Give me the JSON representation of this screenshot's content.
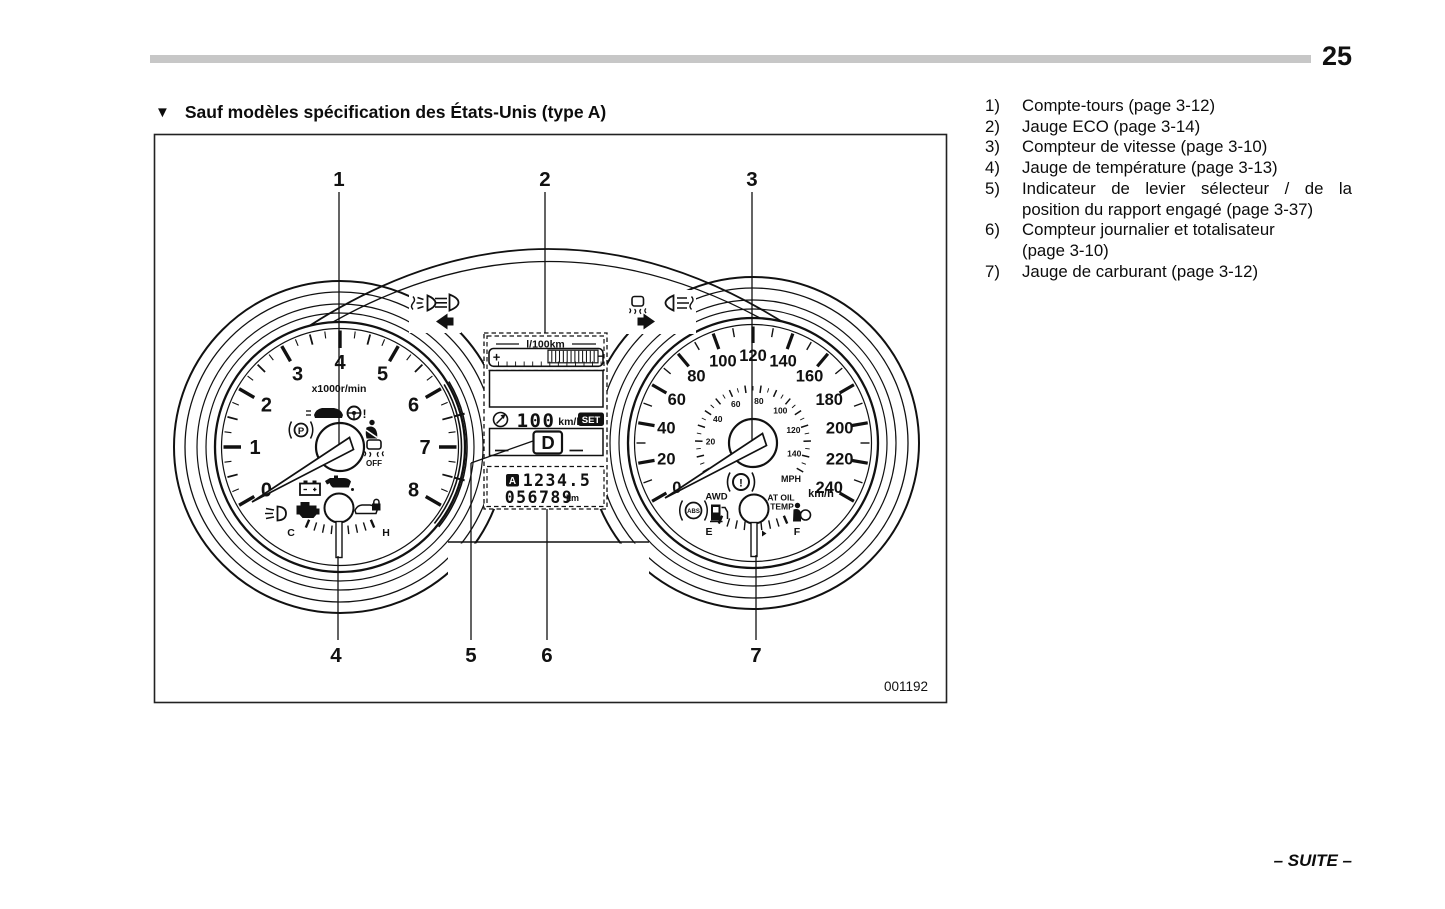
{
  "page": {
    "number": "25",
    "continuation": "– SUITE –"
  },
  "heading": {
    "marker": "▼",
    "text": "Sauf modèles spécification des États-Unis (type A)"
  },
  "figure": {
    "code": "001192"
  },
  "legend": {
    "items": [
      {
        "num": "1)",
        "lines": [
          "Compte-tours (page 3-12)"
        ]
      },
      {
        "num": "2)",
        "lines": [
          "Jauge ECO (page 3-14)"
        ]
      },
      {
        "num": "3)",
        "lines": [
          "Compteur de vitesse (page 3-10)"
        ]
      },
      {
        "num": "4)",
        "lines": [
          "Jauge de température (page 3-13)"
        ]
      },
      {
        "num": "5)",
        "lines": [
          "Indicateur de levier sélecteur / de la",
          "position du rapport engagé (page 3-37)"
        ]
      },
      {
        "num": "6)",
        "lines": [
          "Compteur journalier et totalisateur",
          "(page 3-10)"
        ]
      },
      {
        "num": "7)",
        "lines": [
          "Jauge de carburant (page 3-12)"
        ]
      }
    ]
  },
  "callouts": {
    "labels": [
      "1",
      "2",
      "3",
      "4",
      "5",
      "6",
      "7"
    ]
  },
  "cluster": {
    "tachometer": {
      "unit": "x1000r/min",
      "labels": [
        "0",
        "1",
        "2",
        "3",
        "4",
        "5",
        "6",
        "7",
        "8"
      ]
    },
    "speedometer": {
      "outer_labels": [
        "0",
        "20",
        "40",
        "60",
        "80",
        "100",
        "120",
        "140",
        "160",
        "180",
        "200",
        "220",
        "240"
      ],
      "outer_unit": "km/h",
      "inner_labels": [
        "20",
        "40",
        "60",
        "80",
        "100",
        "120",
        "140"
      ],
      "inner_unit": "MPH"
    },
    "temperature_gauge": {
      "cold": "C",
      "hot": "H"
    },
    "fuel_gauge": {
      "empty": "E",
      "full": "F"
    },
    "indicators": {
      "vdc_off": "OFF",
      "awd": "AWD",
      "abs": "ABS",
      "at_oil_temp_line1": "AT OIL",
      "at_oil_temp_line2": "TEMP",
      "brake_p": "P",
      "brake_excl": "!",
      "power_steering_excl": "!",
      "mph": "MPH",
      "kmh": "km/h"
    },
    "display": {
      "eco_title": "l/100km",
      "plus": "+",
      "minus": "−",
      "cruise_speed": "100",
      "cruise_unit": "km/h",
      "set_label": "SET",
      "gear": "D",
      "trip_label": "A",
      "trip_value": "1234.5",
      "odometer": "056789",
      "odometer_unit": "km"
    }
  }
}
